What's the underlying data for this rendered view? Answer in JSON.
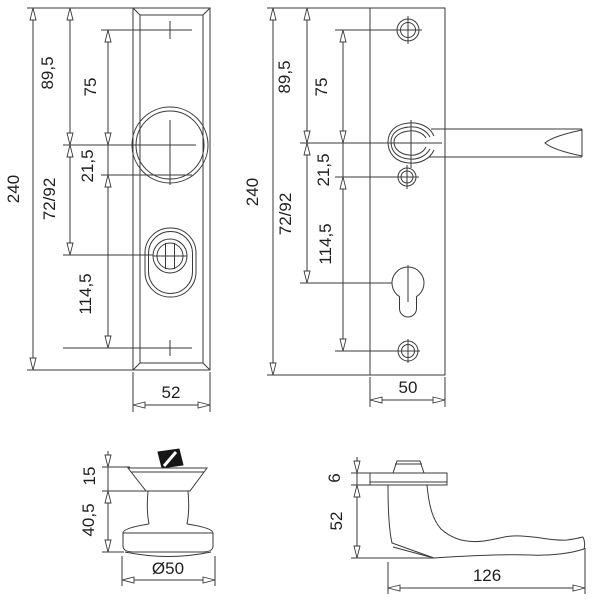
{
  "colors": {
    "background": "#ffffff",
    "line": "#3a3a3a",
    "text": "#1e1e1e",
    "spindle": "#161616"
  },
  "views": {
    "knob_plate_front": {
      "dims": {
        "total_height": "240",
        "top_edge_to_knob": "89,5",
        "screw_to_knob": "75",
        "knob_offset": "21,5",
        "knob_to_cylinder": "72/92",
        "offset_to_bottom_screw": "114,5",
        "width": "52"
      }
    },
    "lever_plate_front": {
      "dims": {
        "total_height": "240",
        "top_edge_to_handle": "89,5",
        "screw_to_handle": "75",
        "handle_offset": "21,5",
        "handle_to_cylinder": "72/92",
        "offset_to_bottom_screw": "114,5",
        "width": "50"
      }
    },
    "knob_side_view": {
      "dims": {
        "head_height": "15",
        "base_height": "40,5",
        "diameter": "Ø50"
      }
    },
    "lever_side_view": {
      "dims": {
        "rose_thickness": "6",
        "height": "52",
        "length": "126"
      }
    }
  }
}
